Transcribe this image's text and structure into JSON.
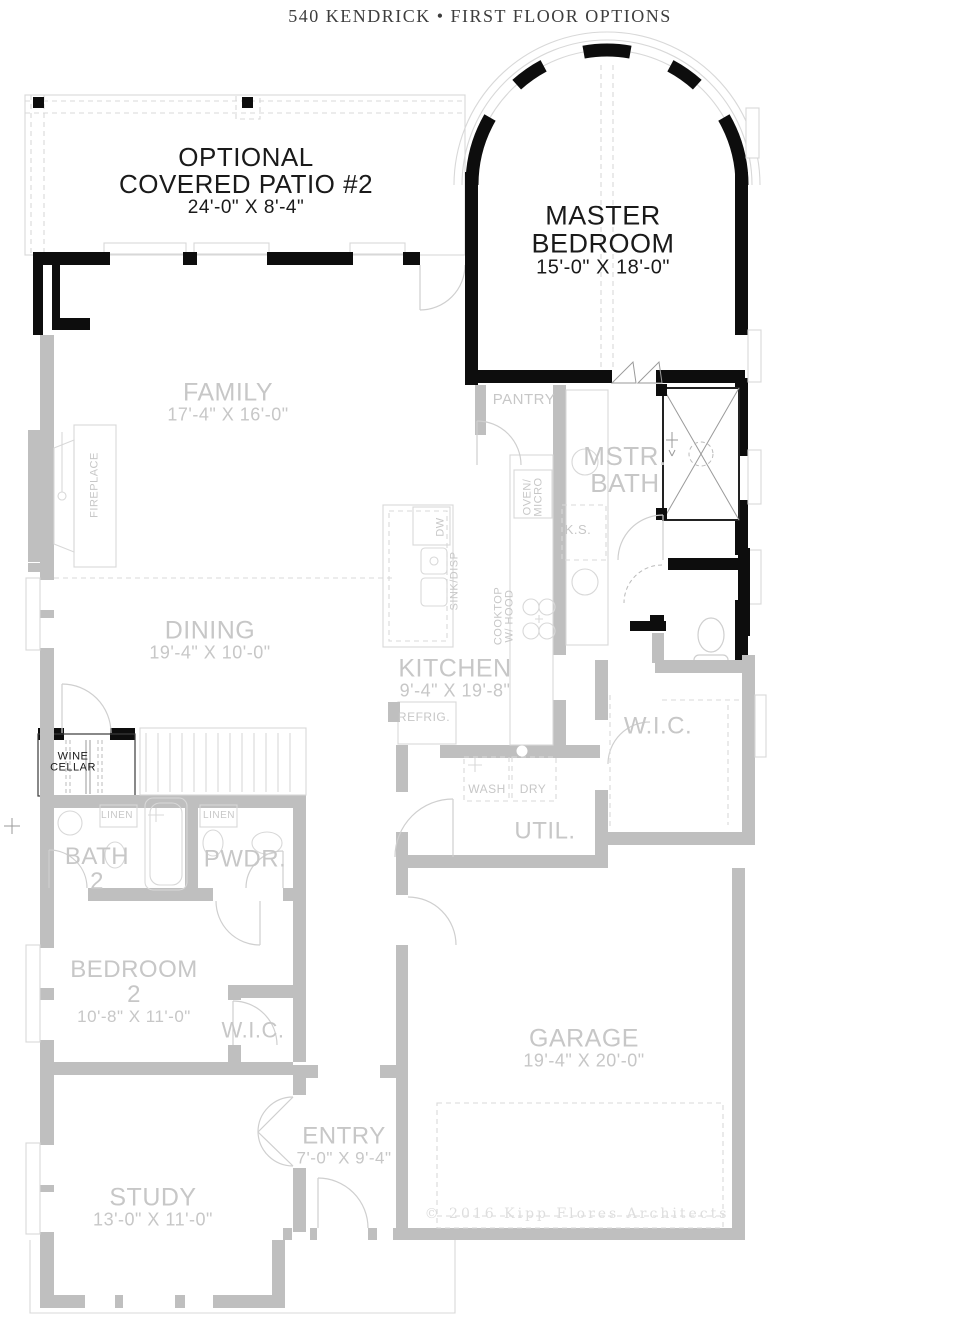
{
  "header": {
    "title": "540 KENDRICK • FIRST FLOOR OPTIONS"
  },
  "footer": {
    "copyright": "© 2016 Kipp Flores Architects"
  },
  "colors": {
    "wall_gray": "#bfbfbf",
    "wall_black": "#0d0d0d",
    "thin_line": "#d8d8d8",
    "label_gray": "#c7c7c7",
    "label_black": "#1a1a1a",
    "title_color": "#3d3d3d",
    "copyright_color": "#dedede"
  },
  "plan": {
    "labels": [
      {
        "id": "optional-covered-patio",
        "x": 246,
        "y": 181,
        "rot": 0,
        "color": "b",
        "lines": [
          {
            "t": "OPTIONAL",
            "s": 26
          },
          {
            "t": "COVERED PATIO #2",
            "s": 26
          },
          {
            "t": "24'-0\" X 8'-4\"",
            "s": 19
          }
        ]
      },
      {
        "id": "master-bedroom",
        "x": 603,
        "y": 240,
        "rot": 0,
        "color": "b",
        "lines": [
          {
            "t": "MASTER",
            "s": 27
          },
          {
            "t": "BEDROOM",
            "s": 27
          },
          {
            "t": "15'-0\" X 18'-0\"",
            "s": 20
          }
        ]
      },
      {
        "id": "family",
        "x": 228,
        "y": 402,
        "rot": 0,
        "color": "g",
        "lines": [
          {
            "t": "FAMILY",
            "s": 25
          },
          {
            "t": "17'-4\" X 16'-0\"",
            "s": 18
          }
        ]
      },
      {
        "id": "pantry",
        "x": 524,
        "y": 400,
        "rot": 0,
        "color": "g",
        "lines": [
          {
            "t": "PANTRY",
            "s": 15
          }
        ]
      },
      {
        "id": "mstr-bath",
        "x": 625,
        "y": 470,
        "rot": 0,
        "color": "g",
        "lines": [
          {
            "t": "MSTR.",
            "s": 26
          },
          {
            "t": "BATH",
            "s": 26
          }
        ]
      },
      {
        "id": "knee-space",
        "x": 578,
        "y": 530,
        "rot": 0,
        "color": "g",
        "lines": [
          {
            "t": "K.S.",
            "s": 13
          }
        ]
      },
      {
        "id": "dining",
        "x": 210,
        "y": 640,
        "rot": 0,
        "color": "g",
        "lines": [
          {
            "t": "DINING",
            "s": 25
          },
          {
            "t": "19'-4\" X 10'-0\"",
            "s": 18
          }
        ]
      },
      {
        "id": "kitchen",
        "x": 455,
        "y": 678,
        "rot": 0,
        "color": "g",
        "lines": [
          {
            "t": "KITCHEN",
            "s": 25
          },
          {
            "t": "9'-4\" X 19'-8\"",
            "s": 18
          }
        ]
      },
      {
        "id": "refrig",
        "x": 424,
        "y": 717,
        "rot": 0,
        "color": "g",
        "lines": [
          {
            "t": "REFRIG.",
            "s": 12
          }
        ]
      },
      {
        "id": "wic-master",
        "x": 658,
        "y": 727,
        "rot": 0,
        "color": "g",
        "lines": [
          {
            "t": "W.I.C.",
            "s": 24
          }
        ]
      },
      {
        "id": "wine-cellar",
        "x": 73,
        "y": 763,
        "rot": 0,
        "color": "b",
        "lines": [
          {
            "t": "WINE",
            "s": 11
          },
          {
            "t": "CELLAR",
            "s": 11
          }
        ]
      },
      {
        "id": "wash",
        "x": 487,
        "y": 789,
        "rot": 0,
        "color": "g",
        "lines": [
          {
            "t": "WASH",
            "s": 12
          }
        ]
      },
      {
        "id": "dry",
        "x": 533,
        "y": 789,
        "rot": 0,
        "color": "g",
        "lines": [
          {
            "t": "DRY",
            "s": 12
          }
        ]
      },
      {
        "id": "util",
        "x": 545,
        "y": 832,
        "rot": 0,
        "color": "g",
        "lines": [
          {
            "t": "UTIL.",
            "s": 24
          }
        ]
      },
      {
        "id": "linen-1",
        "x": 117,
        "y": 816,
        "rot": 0,
        "color": "g",
        "lines": [
          {
            "t": "LINEN",
            "s": 10
          }
        ]
      },
      {
        "id": "linen-2",
        "x": 219,
        "y": 816,
        "rot": 0,
        "color": "g",
        "lines": [
          {
            "t": "LINEN",
            "s": 10
          }
        ]
      },
      {
        "id": "bath-2",
        "x": 97,
        "y": 870,
        "rot": 0,
        "color": "g",
        "lines": [
          {
            "t": "BATH",
            "s": 24
          },
          {
            "t": "2",
            "s": 24
          }
        ]
      },
      {
        "id": "pwdr",
        "x": 245,
        "y": 860,
        "rot": 0,
        "color": "g",
        "lines": [
          {
            "t": "PWDR.",
            "s": 24
          }
        ]
      },
      {
        "id": "bedroom-2",
        "x": 134,
        "y": 992,
        "rot": 0,
        "color": "g",
        "lines": [
          {
            "t": "BEDROOM",
            "s": 24
          },
          {
            "t": "2",
            "s": 24
          },
          {
            "t": "10'-8\" X 11'-0\"",
            "s": 17
          }
        ]
      },
      {
        "id": "wic-2",
        "x": 253,
        "y": 1031,
        "rot": 0,
        "color": "g",
        "lines": [
          {
            "t": "W.I.C.",
            "s": 22
          }
        ]
      },
      {
        "id": "garage",
        "x": 584,
        "y": 1048,
        "rot": 0,
        "color": "g",
        "lines": [
          {
            "t": "GARAGE",
            "s": 25
          },
          {
            "t": "19'-4\" X 20'-0\"",
            "s": 18
          }
        ]
      },
      {
        "id": "entry",
        "x": 344,
        "y": 1146,
        "rot": 0,
        "color": "g",
        "lines": [
          {
            "t": "ENTRY",
            "s": 24
          },
          {
            "t": "7'-0\" X 9'-4\"",
            "s": 17
          }
        ]
      },
      {
        "id": "study",
        "x": 153,
        "y": 1207,
        "rot": 0,
        "color": "g",
        "lines": [
          {
            "t": "STUDY",
            "s": 25
          },
          {
            "t": "13'-0\" X 11'-0\"",
            "s": 18
          }
        ]
      },
      {
        "id": "fireplace",
        "x": 95,
        "y": 485,
        "rot": -90,
        "color": "g",
        "lines": [
          {
            "t": "FIREPLACE",
            "s": 11
          }
        ]
      },
      {
        "id": "oven-micro",
        "x": 534,
        "y": 497,
        "rot": -90,
        "color": "g",
        "lines": [
          {
            "t": "OVEN/",
            "s": 11
          },
          {
            "t": "MICRO",
            "s": 11
          }
        ]
      },
      {
        "id": "dishwasher",
        "x": 441,
        "y": 527,
        "rot": -90,
        "color": "g",
        "lines": [
          {
            "t": "DW",
            "s": 11
          }
        ]
      },
      {
        "id": "sink-disp",
        "x": 455,
        "y": 581,
        "rot": -90,
        "color": "g",
        "lines": [
          {
            "t": "SINK/DISP",
            "s": 11
          }
        ]
      },
      {
        "id": "cooktop-hood",
        "x": 505,
        "y": 616,
        "rot": -90,
        "color": "g",
        "lines": [
          {
            "t": "COOKTOP",
            "s": 11
          },
          {
            "t": "W/ HOOD",
            "s": 11
          }
        ]
      }
    ]
  }
}
